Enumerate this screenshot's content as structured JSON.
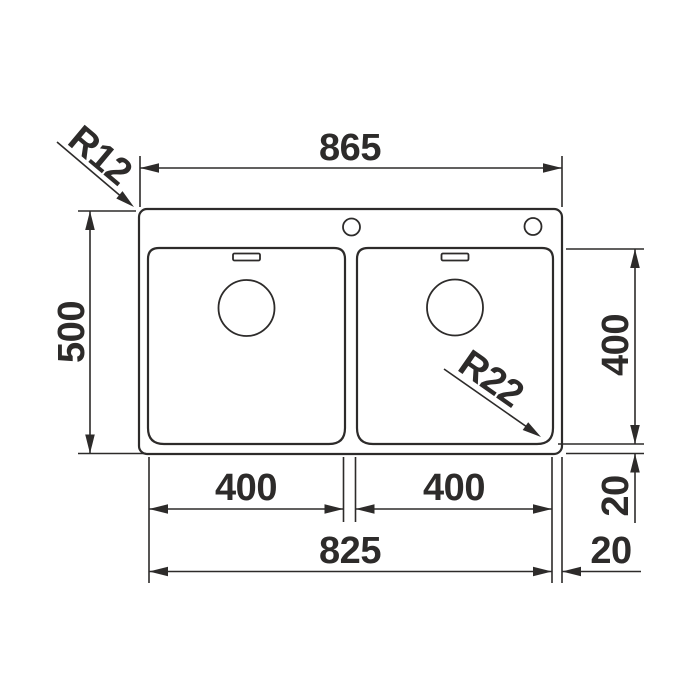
{
  "drawing": {
    "kind": "sink-dimension-drawing",
    "colors": {
      "line": "#2d2b2a",
      "background": "#ffffff"
    },
    "dims": {
      "overall_width": "865",
      "overall_depth": "500",
      "left_bowl_width": "400",
      "right_bowl_width": "400",
      "bowl_depth": "400",
      "bowl_span": "825",
      "rim_offset_bottom": "20",
      "rim_offset_side": "20",
      "outer_corner_radius": "R12",
      "bowl_corner_radius": "R22"
    }
  }
}
